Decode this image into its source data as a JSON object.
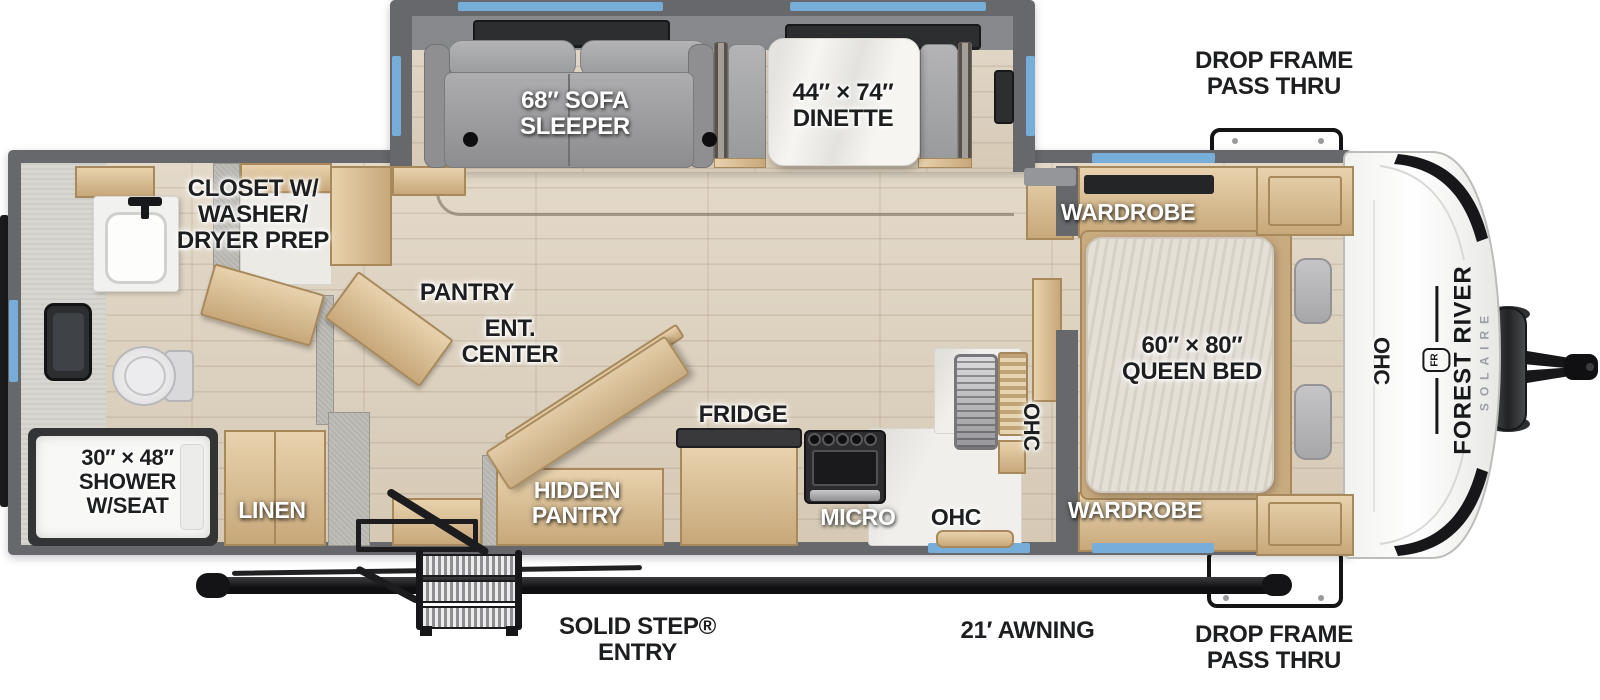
{
  "brand": {
    "make": "FOREST RIVER",
    "model": "SOLAIRE",
    "badge": "FR"
  },
  "callouts": {
    "drop_frame_top": "DROP FRAME\nPASS THRU",
    "drop_frame_bottom": "DROP FRAME\nPASS THRU",
    "awning": "21′ AWNING",
    "entry": "SOLID STEP®\nENTRY"
  },
  "living_area": {
    "sofa": "68″ SOFA\nSLEEPER",
    "dinette": "44″ × 74″\nDINETTE",
    "pantry": "PANTRY",
    "ent_center": "ENT.\nCENTER",
    "hidden_pantry": "HIDDEN\nPANTRY"
  },
  "kitchen": {
    "fridge": "FRIDGE",
    "micro": "MICRO",
    "ohc": "OHC",
    "ohc_sink": "OHC"
  },
  "bedroom": {
    "wardrobe_top": "WARDROBE",
    "wardrobe_bottom": "WARDROBE",
    "bed": "60″ × 80″\nQUEEN BED",
    "ohc_front": "OHC"
  },
  "bathroom": {
    "closet": "CLOSET W/\nWASHER/\nDRYER PREP",
    "shower": "30″ × 48″\nSHOWER\nW/SEAT",
    "linen": "LINEN"
  },
  "colors": {
    "window_accent": "#76add9",
    "wall_gray": "#66686c",
    "floor_wood": "#ddd2c0",
    "cabinet_wood": "#d6bb92",
    "fabric_gray": "#a6a6a8",
    "label_black": "#1d1e20"
  }
}
